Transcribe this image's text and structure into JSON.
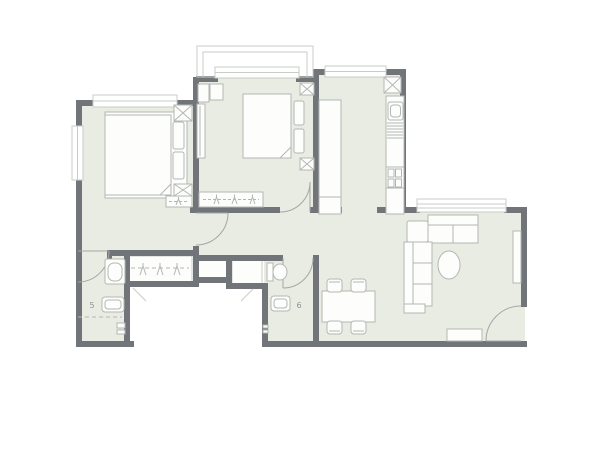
{
  "labels": {
    "bathroom_left_fixture": "5",
    "bathroom_middle_fixture": "6"
  },
  "colors": {
    "background": "#ffffff",
    "floor": "#e9ece3",
    "wall": "#71757a",
    "furniture_stroke": "#b3b7b3",
    "furniture_fill": "#fdfdfb",
    "door_arc": "#a2a7a7",
    "frame_line": "#c9cdc7",
    "label_text": "#8d9494"
  },
  "plan": {
    "type": "apartment-floor-plan",
    "rooms": [
      "bedroom-left",
      "bedroom-middle",
      "kitchen",
      "hallway",
      "living-dining-room",
      "bathroom-left",
      "bathroom-middle",
      "wardrobe-corridor",
      "bay-window",
      "entry"
    ],
    "furniture_icons": [
      "double-bed-icon",
      "pillow-icon",
      "nightstand-icon",
      "wardrobe-icon",
      "hanger-rod-icon",
      "kitchen-counter-icon",
      "sink-icon",
      "stove-icon",
      "vent-shaft-icon",
      "sofa-icon",
      "coffee-table-icon",
      "tv-bench-icon",
      "dining-table-icon",
      "chair-icon",
      "toilet-icon",
      "washbasin-icon",
      "door-swing-icon",
      "window-icon",
      "doormat-icon"
    ]
  }
}
